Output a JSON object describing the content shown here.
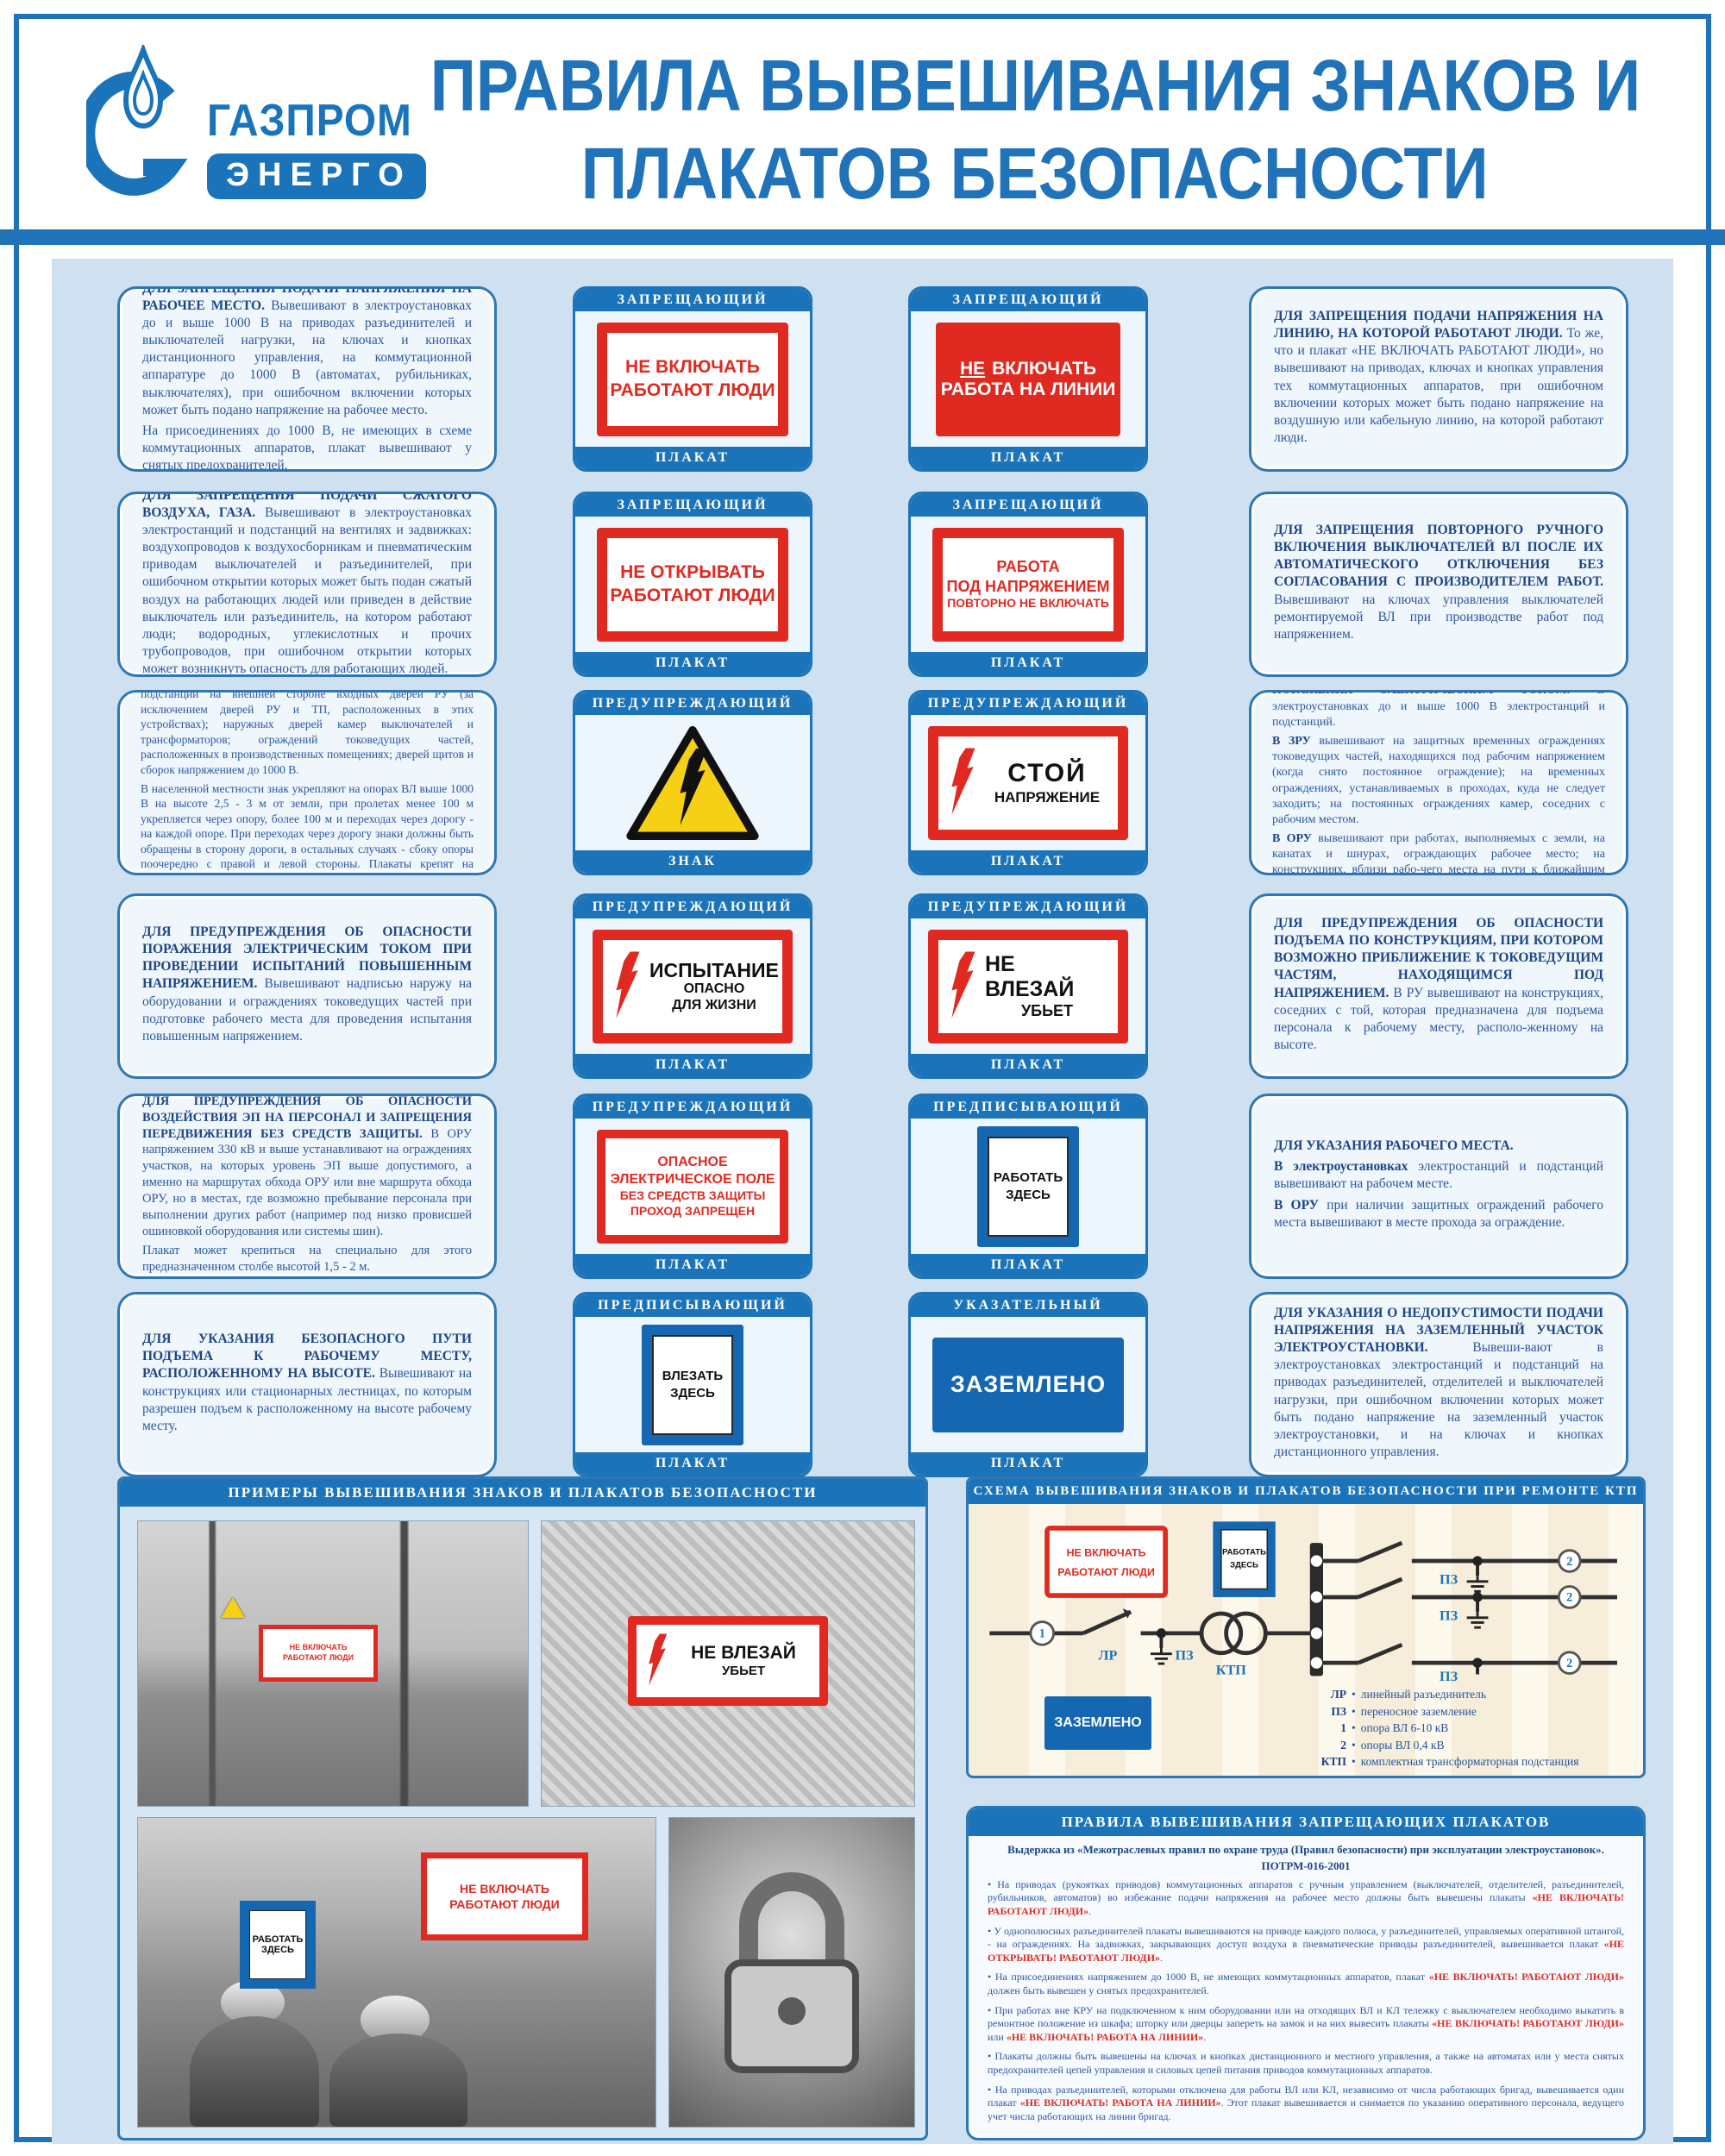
{
  "poster": {
    "brand": "ГАЗПРОМ",
    "brand_sub": "ЭНЕРГО",
    "title_line1": "ПРАВИЛА ВЫВЕШИВАНИЯ ЗНАКОВ И",
    "title_line2": "ПЛАКАТОВ БЕЗОПАСНОСТИ"
  },
  "signs": {
    "ne_vklyuchat_rabotayut": {
      "l1": "НЕ ВКЛЮЧАТЬ",
      "l2": "РАБОТАЮТ ЛЮДИ"
    },
    "ne_vklyuchat_liniya": {
      "l1a": "НЕ",
      "l1b": "ВКЛЮЧАТЬ",
      "l2": "РАБОТА НА ЛИНИИ"
    },
    "ne_otkryvat": {
      "l1": "НЕ ОТКРЫВАТЬ",
      "l2": "РАБОТАЮТ ЛЮДИ"
    },
    "rabota_pod_napr": {
      "l1": "РАБОТА",
      "l2": "ПОД НАПРЯЖЕНИЕМ",
      "l3": "ПОВТОРНО НЕ ВКЛЮЧАТЬ"
    },
    "stoy": {
      "l1": "СТОЙ",
      "l2": "НАПРЯЖЕНИЕ"
    },
    "ispytanie": {
      "l1": "ИСПЫТАНИЕ",
      "l2": "ОПАСНО",
      "l3": "ДЛЯ ЖИЗНИ"
    },
    "ne_vlezay": {
      "l1": "НЕ ВЛЕЗАЙ",
      "l2": "УБЬЕТ"
    },
    "opasnoe_pole": {
      "l1": "ОПАСНОЕ",
      "l2": "ЭЛЕКТРИЧЕСКОЕ ПОЛЕ",
      "l3": "БЕЗ СРЕДСТВ ЗАЩИТЫ",
      "l4": "ПРОХОД ЗАПРЕЩЕН"
    },
    "rabotat_zdes": {
      "l1": "РАБОТАТЬ",
      "l2": "ЗДЕСЬ"
    },
    "vlezat_zdes": {
      "l1": "ВЛЕЗАТЬ",
      "l2": "ЗДЕСЬ"
    },
    "zazemleno": {
      "l1": "ЗАЗЕМЛЕНО"
    }
  },
  "rows": [
    {
      "left": {
        "heading": "ДЛЯ ЗАПРЕЩЕНИЯ ПОДАЧИ НАПРЯЖЕНИЯ НА РАБОЧЕЕ МЕСТО.",
        "body": "Вывешивают в электроустановках до и выше 1000 В на приводах разъединителей и выключателей нагрузки, на ключах и кнопках дистанционного управления, на коммутационной аппаратуре до 1000 В (автоматах, рубильниках, выключателях), при ошибочном включении которых может быть подано напряжение на рабочее место.",
        "p2": "На присоединениях до 1000 В, не имеющих в схеме коммутационных аппаратов, плакат вывешивают у снятых предохранителей."
      },
      "card1": {
        "category": "ЗАПРЕЩАЮЩИЙ",
        "footer": "ПЛАКАТ"
      },
      "card2": {
        "category": "ЗАПРЕЩАЮЩИЙ",
        "footer": "ПЛАКАТ"
      },
      "right": {
        "heading": "ДЛЯ ЗАПРЕЩЕНИЯ ПОДАЧИ НАПРЯЖЕНИЯ НА ЛИНИЮ, НА КОТОРОЙ РАБОТАЮТ ЛЮДИ.",
        "body": "То же, что и плакат «НЕ ВКЛЮЧАТЬ РАБОТАЮТ ЛЮДИ», но вывешивают на приводах, ключах и кнопках управления тех коммутационных аппаратов, при ошибочном включении которых может быть подано напряжение на воздушную или кабельную линию, на которой работают люди."
      }
    },
    {
      "left": {
        "heading": "ДЛЯ ЗАПРЕЩЕНИЯ ПОДАЧИ СЖАТОГО ВОЗДУХА, ГАЗА.",
        "body": "Вывешивают в электроустановках электростанций и подстанций на вентилях и задвижках: воздухопроводов к воздухосборникам и пневматическим приводам выключателей и разъединителей, при ошибочном открытии которых может быть подан сжатый воздух на работающих людей или приведен в действие выключатель или разъединитель, на котором работают люди; водородных, углекислотных и прочих трубопроводов, при ошибочном открытии которых может возникнуть опасность для работающих людей."
      },
      "card1": {
        "category": "ЗАПРЕЩАЮЩИЙ",
        "footer": "ПЛАКАТ"
      },
      "card2": {
        "category": "ЗАПРЕЩАЮЩИЙ",
        "footer": "ПЛАКАТ"
      },
      "right": {
        "heading": "ДЛЯ ЗАПРЕЩЕНИЯ ПОВТОРНОГО РУЧНОГО ВКЛЮЧЕНИЯ ВЫКЛЮЧАТЕЛЕЙ ВЛ ПОСЛЕ ИХ АВТОМАТИЧЕСКОГО ОТКЛЮЧЕНИЯ БЕЗ СОГЛАСОВАНИЯ С ПРОИЗВОДИТЕЛЕМ РАБОТ.",
        "body": "Вывешивают на ключах управления выключателей ремонтируемой ВЛ при производстве работ под напряжением."
      }
    },
    {
      "left": {
        "heading": "ДЛЯ ПРЕДУПРЕЖДЕНИЯ ОБ ОПАСНОСТИ ПОРАЖЕНИЯ ЭЛЕКТРИЧЕСКИМ ТОКОМ.",
        "body": "Знак укрепляют в электроустановках до и выше 1000 В электростанций и подстанций на внешней стороне входных дверей РУ (за исключением дверей РУ и ТП, расположенных в этих устройствах); наружных дверей камер выключателей и трансформаторов; ограждений токоведущих частей, расположенных в производственных помещениях; дверей щитов и сборок напряжением до 1000 В.",
        "p2": "В населенной местности знак укрепляют на опорах ВЛ выше 1000 В на высоте 2,5 - 3 м от земли, при пролетах менее 100 м укрепляется через опору, более 100 м и переходах через дорогу - на каждой опоре. При переходах через дорогу знаки должны быть обращены в сторону дороги, в остальных случаях - сбоку опоры поочередно с правой и левой стороны. Плакаты крепят на металлических и деревянных опорах.",
        "p3": "На железобетонные опоры ВЛ и ограждения ОРУ из бетонных плит знак наносят трафаретом."
      },
      "card1": {
        "category": "ПРЕДУПРЕЖДАЮЩИЙ",
        "footer": "ЗНАК"
      },
      "card2": {
        "category": "ПРЕДУПРЕЖДАЮЩИЙ",
        "footer": "ПЛАКАТ"
      },
      "right": {
        "heading": "ДЛЯ ПРЕДУПРЕЖДЕНИЯ ОБ ОПАСНОСТИ ПОРАЖЕНИЯ ЭЛЕКТРИЧЕСКИМ ТОКОМ.",
        "body": "В электроустановках до и выше 1000 В электростанций и подстанций.",
        "p2_lead": "В ЗРУ",
        "p2_body": "вывешивают на защитных временных ограждениях токоведущих частей, находящихся под рабочим напряжением (когда снято постоянное ограждение); на временных ограждениях, устанавливаемых в проходах, куда не следует заходить; на постоянных ограждениях камер, соседних с рабочим местом.",
        "p3_lead": "В ОРУ",
        "p3_body": "вывешивают при работах, выполняемых с земли, на канатах и шнурах, ограждающих рабочее место; на конструкциях, вблизи рабо-чего места на пути к ближайшим токоведущим частям, находящимся под напряжением."
      }
    },
    {
      "left": {
        "heading": "ДЛЯ ПРЕДУПРЕЖДЕНИЯ ОБ ОПАСНОСТИ ПОРАЖЕНИЯ ЭЛЕКТРИЧЕСКИМ ТОКОМ ПРИ ПРОВЕДЕНИИ ИСПЫТАНИЙ ПОВЫШЕННЫМ НАПРЯЖЕНИЕМ.",
        "body": "Вывешивают надписью наружу на оборудовании и ограждениях токоведущих частей при подготовке рабочего места для проведения испытания повышенным напряжением."
      },
      "card1": {
        "category": "ПРЕДУПРЕЖДАЮЩИЙ",
        "footer": "ПЛАКАТ"
      },
      "card2": {
        "category": "ПРЕДУПРЕЖДАЮЩИЙ",
        "footer": "ПЛАКАТ"
      },
      "right": {
        "heading": "ДЛЯ ПРЕДУПРЕЖДЕНИЯ ОБ ОПАСНОСТИ ПОДЪЕМА ПО КОНСТРУКЦИЯМ, ПРИ КОТОРОМ ВОЗМОЖНО ПРИБЛИЖЕНИЕ К ТОКОВЕДУЩИМ ЧАСТЯМ, НАХОДЯЩИМСЯ ПОД НАПРЯЖЕНИЕМ.",
        "body": "В РУ вывешивают на конструкциях, соседних с той, которая предназначена для подъема персонала к рабочему месту, располо-женному на высоте."
      }
    },
    {
      "left": {
        "heading": "ДЛЯ ПРЕДУПРЕЖДЕНИЯ ОБ ОПАСНОСТИ ВОЗДЕЙСТВИЯ ЭП НА ПЕРСОНАЛ И ЗАПРЕЩЕНИЯ ПЕРЕДВИЖЕНИЯ БЕЗ СРЕДСТВ ЗАЩИТЫ.",
        "body": "В ОРУ напряжением 330 кВ и выше устанавливают на ограждениях участков, на которых уровень ЭП выше допустимого, а именно на маршрутах обхода ОРУ или вне маршрута обхода ОРУ, но в местах, где возможно пребывание персонала при выполнении других работ (например под низко провисшей ошиновкой оборудования или системы шин).",
        "p2": "Плакат может крепиться на специально для этого предназначенном столбе высотой 1,5 - 2 м."
      },
      "card1": {
        "category": "ПРЕДУПРЕЖДАЮЩИЙ",
        "footer": "ПЛАКАТ"
      },
      "card2": {
        "category": "ПРЕДПИСЫВАЮЩИЙ",
        "footer": "ПЛАКАТ"
      },
      "right": {
        "heading": "ДЛЯ УКАЗАНИЯ РАБОЧЕГО МЕСТА.",
        "p1_lead": "В электроустановках",
        "p1_body": "электростанций и подстанций вывешивают на рабочем месте.",
        "p2_lead": "В ОРУ",
        "p2_body": "при наличии защитных ограждений рабочего места вывешивают в месте прохода за ограждение."
      }
    },
    {
      "left": {
        "heading": "ДЛЯ УКАЗАНИЯ БЕЗОПАСНОГО ПУТИ ПОДЪЕМА К РАБОЧЕМУ МЕСТУ, РАСПОЛОЖЕННОМУ НА ВЫСОТЕ.",
        "body": "Вывешивают на конструкциях или стационарных лестницах, по которым разрешен подъем к расположенному на высоте рабочему месту."
      },
      "card1": {
        "category": "ПРЕДПИСЫВАЮЩИЙ",
        "footer": "ПЛАКАТ"
      },
      "card2": {
        "category": "УКАЗАТЕЛЬНЫЙ",
        "footer": "ПЛАКАТ"
      },
      "right": {
        "heading": "ДЛЯ УКАЗАНИЯ О НЕДОПУСТИМОСТИ ПОДАЧИ НАПРЯЖЕНИЯ НА ЗАЗЕМЛЕННЫЙ УЧАСТОК ЭЛЕКТРОУСТАНОВКИ.",
        "body": "Вывеши-вают в электроустановках электростанций и подстанций на приводах разъединителей, отделителей и выключателей нагрузки, при ошибочном включении которых может быть подано напряжение на заземленный участок электроустановки, и на ключах и кнопках дистанционного управления."
      }
    }
  ],
  "examples": {
    "title": "ПРИМЕРЫ ВЫВЕШИВАНИЯ ЗНАКОВ И ПЛАКАТОВ БЕЗОПАСНОСТИ"
  },
  "scheme": {
    "title": "СХЕМА ВЫВЕШИВАНИЯ ЗНАКОВ И ПЛАКАТОВ БЕЗОПАСНОСТИ ПРИ РЕМОНТЕ КТП",
    "labels": {
      "lr": "ЛР",
      "pz": "ПЗ",
      "ktp": "КТП",
      "n1": "1",
      "n2": "2"
    },
    "legend": [
      {
        "k": "ЛР",
        "v": "линейный разъединитель"
      },
      {
        "k": "ПЗ",
        "v": "переносное заземление"
      },
      {
        "k": "1",
        "v": "опора ВЛ 6-10 кВ"
      },
      {
        "k": "2",
        "v": "опоры ВЛ 0,4 кВ"
      },
      {
        "k": "КТП",
        "v": "комплектная трансформаторная подстанция"
      }
    ]
  },
  "rules": {
    "title": "ПРАВИЛА ВЫВЕШИВАНИЯ ЗАПРЕЩАЮЩИХ ПЛАКАТОВ",
    "subtitle1": "Выдержка из «Межотраслевых правил по охране труда (Правил безопасности) при эксплуатации электроустановок».",
    "subtitle2": "ПОТРМ-016-2001",
    "bullets": [
      [
        {
          "t": "•  На приводах (рукоятках приводов) коммутационных аппаратов с ручным управлением (выключателей, отделителей, разъединителей, рубильников, автоматов) во избежание подачи напряжения на рабочее место должны быть вывешены плакаты "
        },
        {
          "t": "«НЕ ВКЛЮЧАТЬ! РАБОТАЮТ ЛЮДИ»",
          "red": true
        },
        {
          "t": "."
        }
      ],
      [
        {
          "t": "•  У однополюсных разъединителей плакаты вывешиваются на приводе каждого полюса, у разъединителей, управляемых оперативной штангой, - на ограждениях. На задвижках, закрывающих доступ воздуха в пневматические приводы разъединителей, вывешивается плакат "
        },
        {
          "t": "«НЕ ОТКРЫВАТЬ! РАБОТАЮТ ЛЮДИ»",
          "red": true
        },
        {
          "t": "."
        }
      ],
      [
        {
          "t": "•  На присоединениях напряжением до 1000 В, не имеющих коммутационных аппаратов, плакат "
        },
        {
          "t": "«НЕ ВКЛЮЧАТЬ! РАБОТАЮТ ЛЮДИ»",
          "red": true
        },
        {
          "t": " должен быть вывешен у снятых предохранителей."
        }
      ],
      [
        {
          "t": "•  При работах вне КРУ на подключенном к ним оборудовании или на отходящих ВЛ и КЛ тележку с выключателем необходимо выкатить в ремонтное положение из шкафа; шторку или дверцы запереть на замок и на них вывесить плакаты "
        },
        {
          "t": "«НЕ ВКЛЮЧАТЬ! РАБОТАЮТ ЛЮДИ»",
          "red": true
        },
        {
          "t": " или "
        },
        {
          "t": "«НЕ ВКЛЮЧАТЬ! РАБОТА НА ЛИНИИ»",
          "red": true
        },
        {
          "t": "."
        }
      ],
      [
        {
          "t": "•  Плакаты должны быть вывешены на ключах и кнопках дистанционного и местного управления, а также на автоматах или у места снятых предохранителей цепей управления и силовых цепей питания приводов коммутационных аппаратов."
        }
      ],
      [
        {
          "t": "•  На приводах разъединителей, которыми отключена для работы ВЛ или КЛ, независимо от числа работающих бригад, вывешивается один плакат "
        },
        {
          "t": "«НЕ ВКЛЮЧАТЬ! РАБОТА НА ЛИНИИ»",
          "red": true
        },
        {
          "t": ". Этот плакат вывешивается и снимается по указанию оперативного персонала, ведущего учет числа работающих на линии бригад."
        }
      ]
    ]
  },
  "colors": {
    "accent_blue": "#1b74ba",
    "sign_red": "#e02a21",
    "sign_blue": "#1467b0",
    "warn_yellow": "#f5d014"
  }
}
